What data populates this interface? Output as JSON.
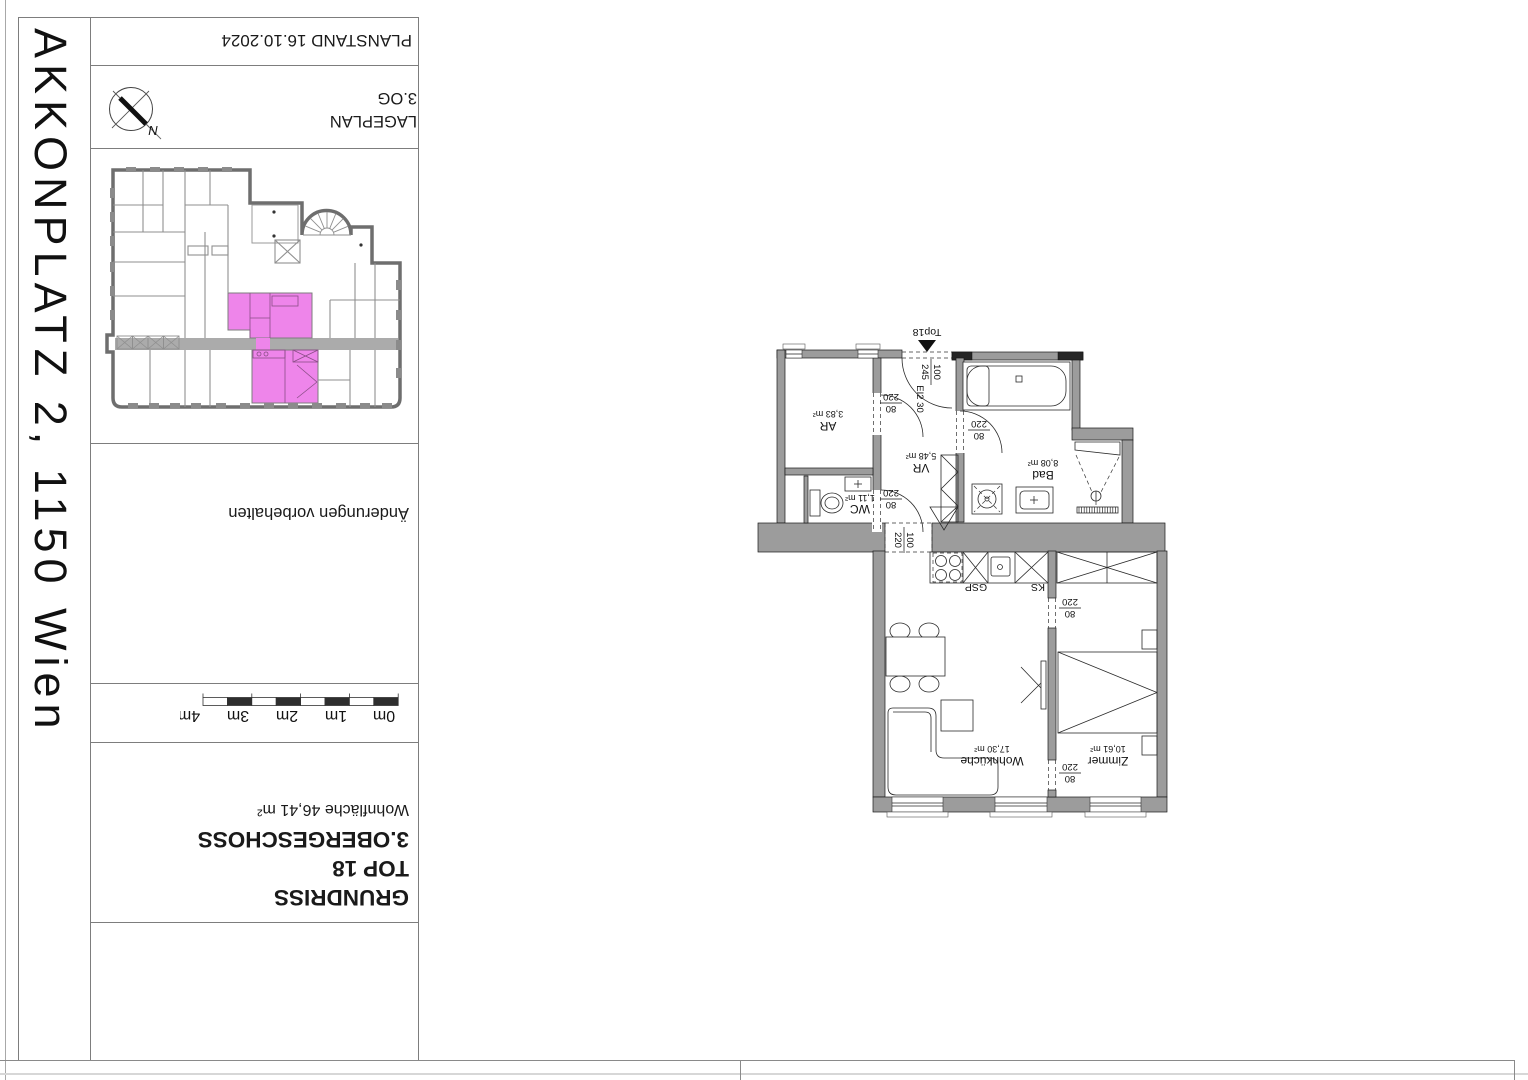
{
  "sheet_title": "AKKONPLATZ 2, 1150 Wien",
  "titleblock": {
    "planstand": "PLANSTAND 16.10.2024",
    "lageplan": "LAGEPLAN",
    "lageplan_floor": "3.OG",
    "north": "N",
    "note": "Änderungen vorbehalten",
    "scalebar_labels": [
      "4m",
      "3m",
      "2m",
      "1m",
      "0m"
    ],
    "drawing_type": "GRUNDRISS",
    "unit": "TOP 18",
    "floor": "3.OBERGESCHOSS",
    "living_area": "Wohnfläche 46,41 m²"
  },
  "floorplan": {
    "entrance": {
      "label": "Top18",
      "door_w": "100",
      "door_h": "245",
      "door_class": "EI2 30"
    },
    "passage": {
      "w": "100",
      "h": "220"
    },
    "doors": {
      "w": "80",
      "h": "220"
    },
    "rooms": {
      "ar": {
        "name": "AR",
        "area": "3,83 m²"
      },
      "vr": {
        "name": "VR",
        "area": "5,48 m²"
      },
      "wc": {
        "name": "WC",
        "area": "1,11 m²"
      },
      "bad": {
        "name": "Bad",
        "area": "8,08 m²"
      },
      "wk": {
        "name": "Wohnküche",
        "area": "17,30 m²"
      },
      "zi": {
        "name": "Zimmer",
        "area": "10,61 m²"
      }
    },
    "kitchen": {
      "gsp": "GSP",
      "ks": "KS"
    }
  },
  "colors": {
    "highlight": "#ee85ea",
    "wall": "#9c9c9c"
  }
}
